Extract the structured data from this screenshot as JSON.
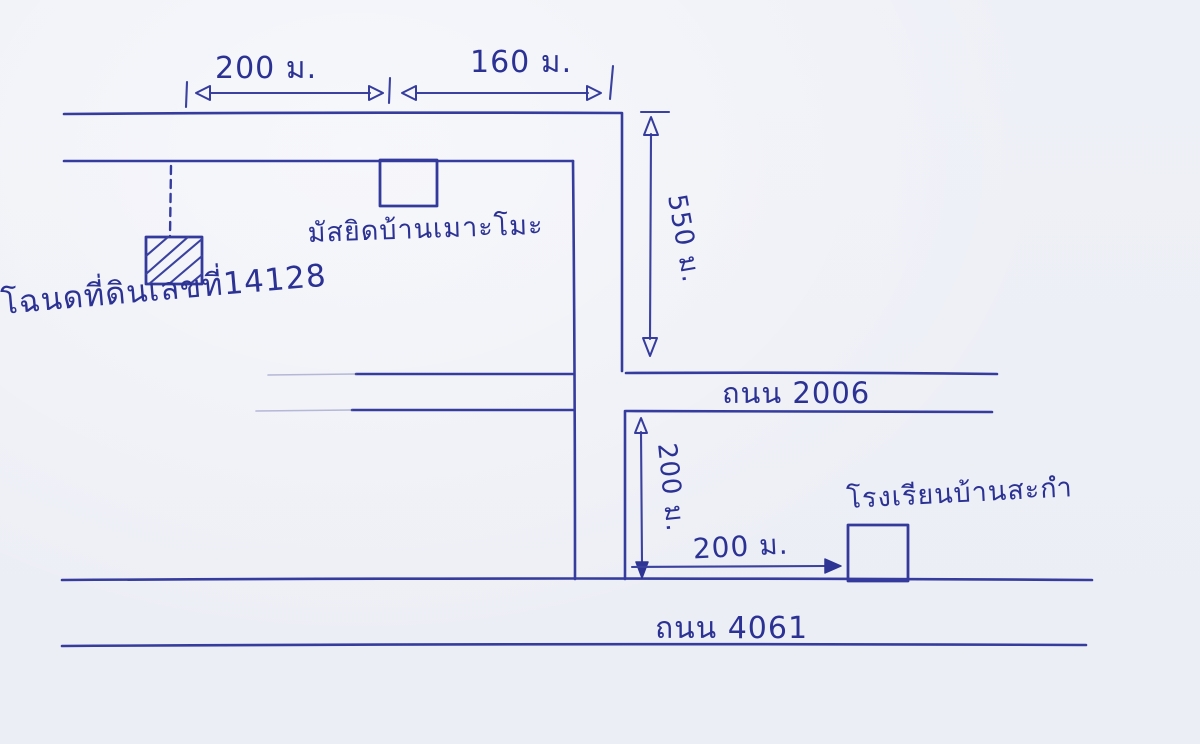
{
  "colors": {
    "paper": "#eef0f7",
    "ink": "#333a9b"
  },
  "measurements": {
    "top_left_distance": "200 ม.",
    "top_right_distance": "160 ม.",
    "side_road_length": "550 ม.",
    "cross_road_length": "200 ม.",
    "school_distance": "200 ม."
  },
  "roads": {
    "middle_road": "ถนน 2006",
    "bottom_road": "ถนน 4061"
  },
  "places": {
    "mosque": "มัสยิดบ้านเมาะโมะ",
    "land_deed": "โฉนดที่ดินเลขที่14128",
    "school": "โรงเรียนบ้านสะกำ"
  }
}
